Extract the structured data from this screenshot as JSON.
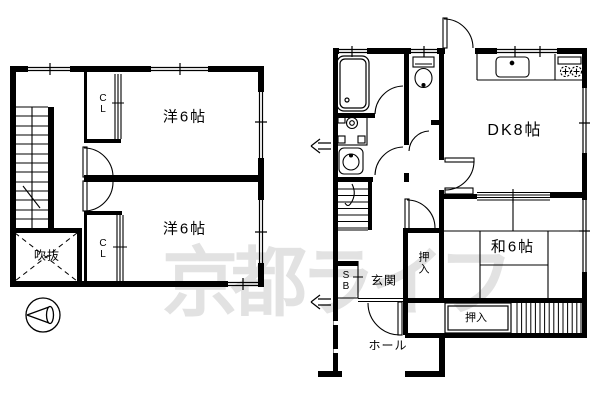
{
  "watermark": {
    "text": "京都ライフ",
    "color": "#e2e2e2"
  },
  "plans": {
    "second_floor": {
      "room1": "洋6帖",
      "room2": "洋6帖",
      "closet1": "C\nL",
      "closet2": "C\nL",
      "void": "吹抜"
    },
    "first_floor": {
      "dining_kitchen": "DK8帖",
      "japanese_room": "和6帖",
      "oshiire_vertical": "押\n入",
      "oshiire_horizontal": "押入",
      "shoe_box": "S\nB",
      "entrance": "玄関",
      "hall": "ホール"
    }
  },
  "colors": {
    "line": "#000000",
    "background": "#ffffff",
    "watermark_gray": "#e2e2e2"
  }
}
